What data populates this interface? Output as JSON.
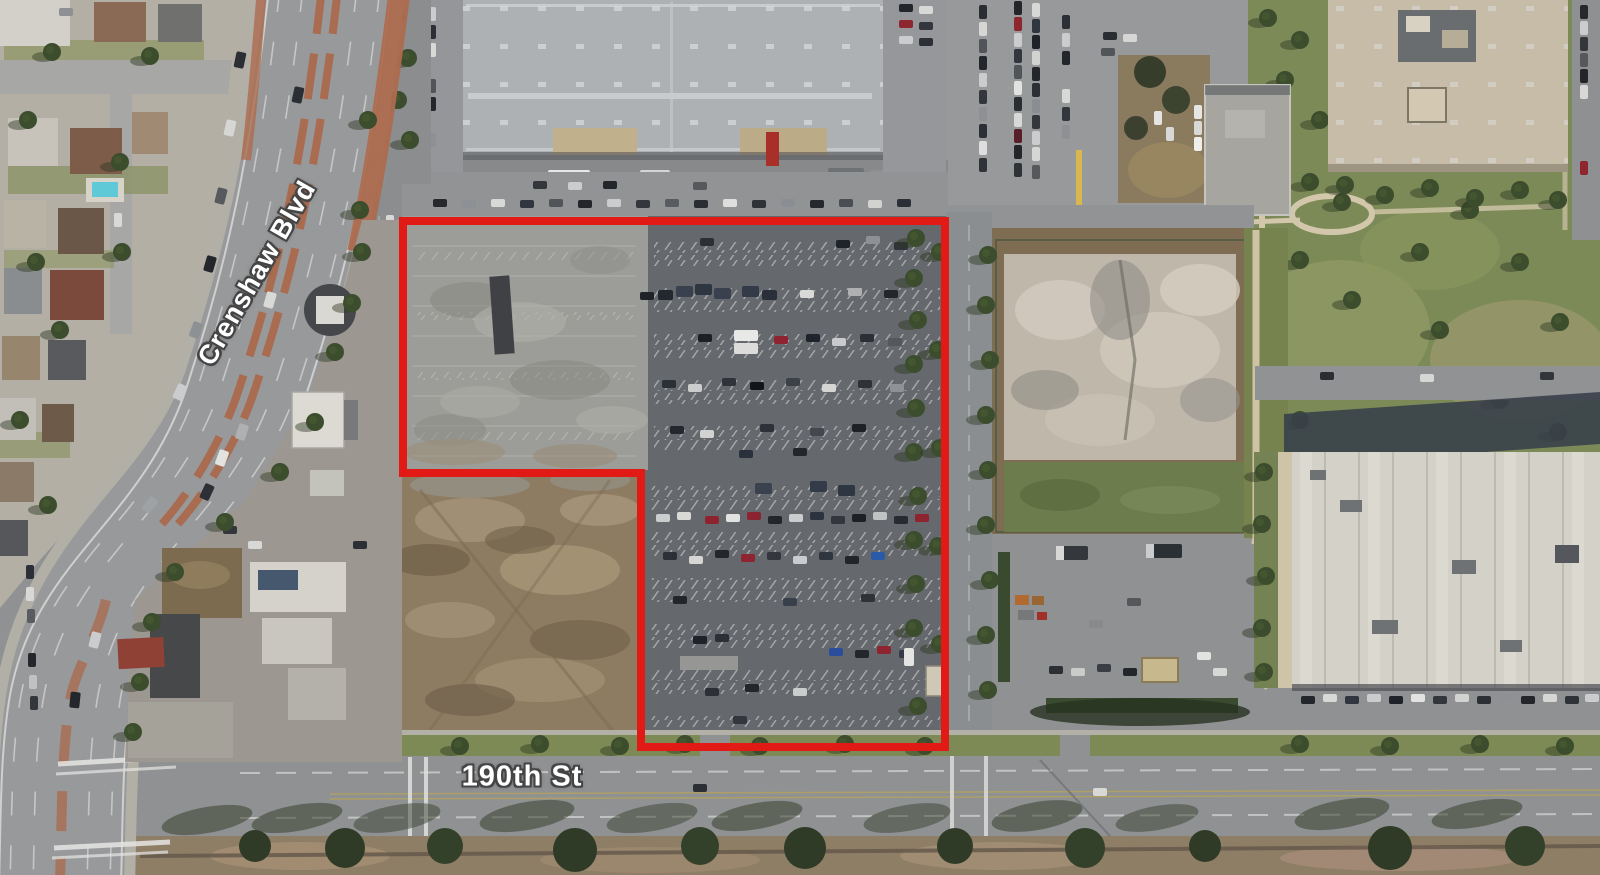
{
  "map": {
    "type": "aerial-satellite-view",
    "road_labels": [
      {
        "id": "crenshaw-blvd",
        "text": "Crenshaw Blvd"
      },
      {
        "id": "190th-st",
        "text": "190th St"
      }
    ],
    "boundary": {
      "color": "#e11a15"
    }
  }
}
